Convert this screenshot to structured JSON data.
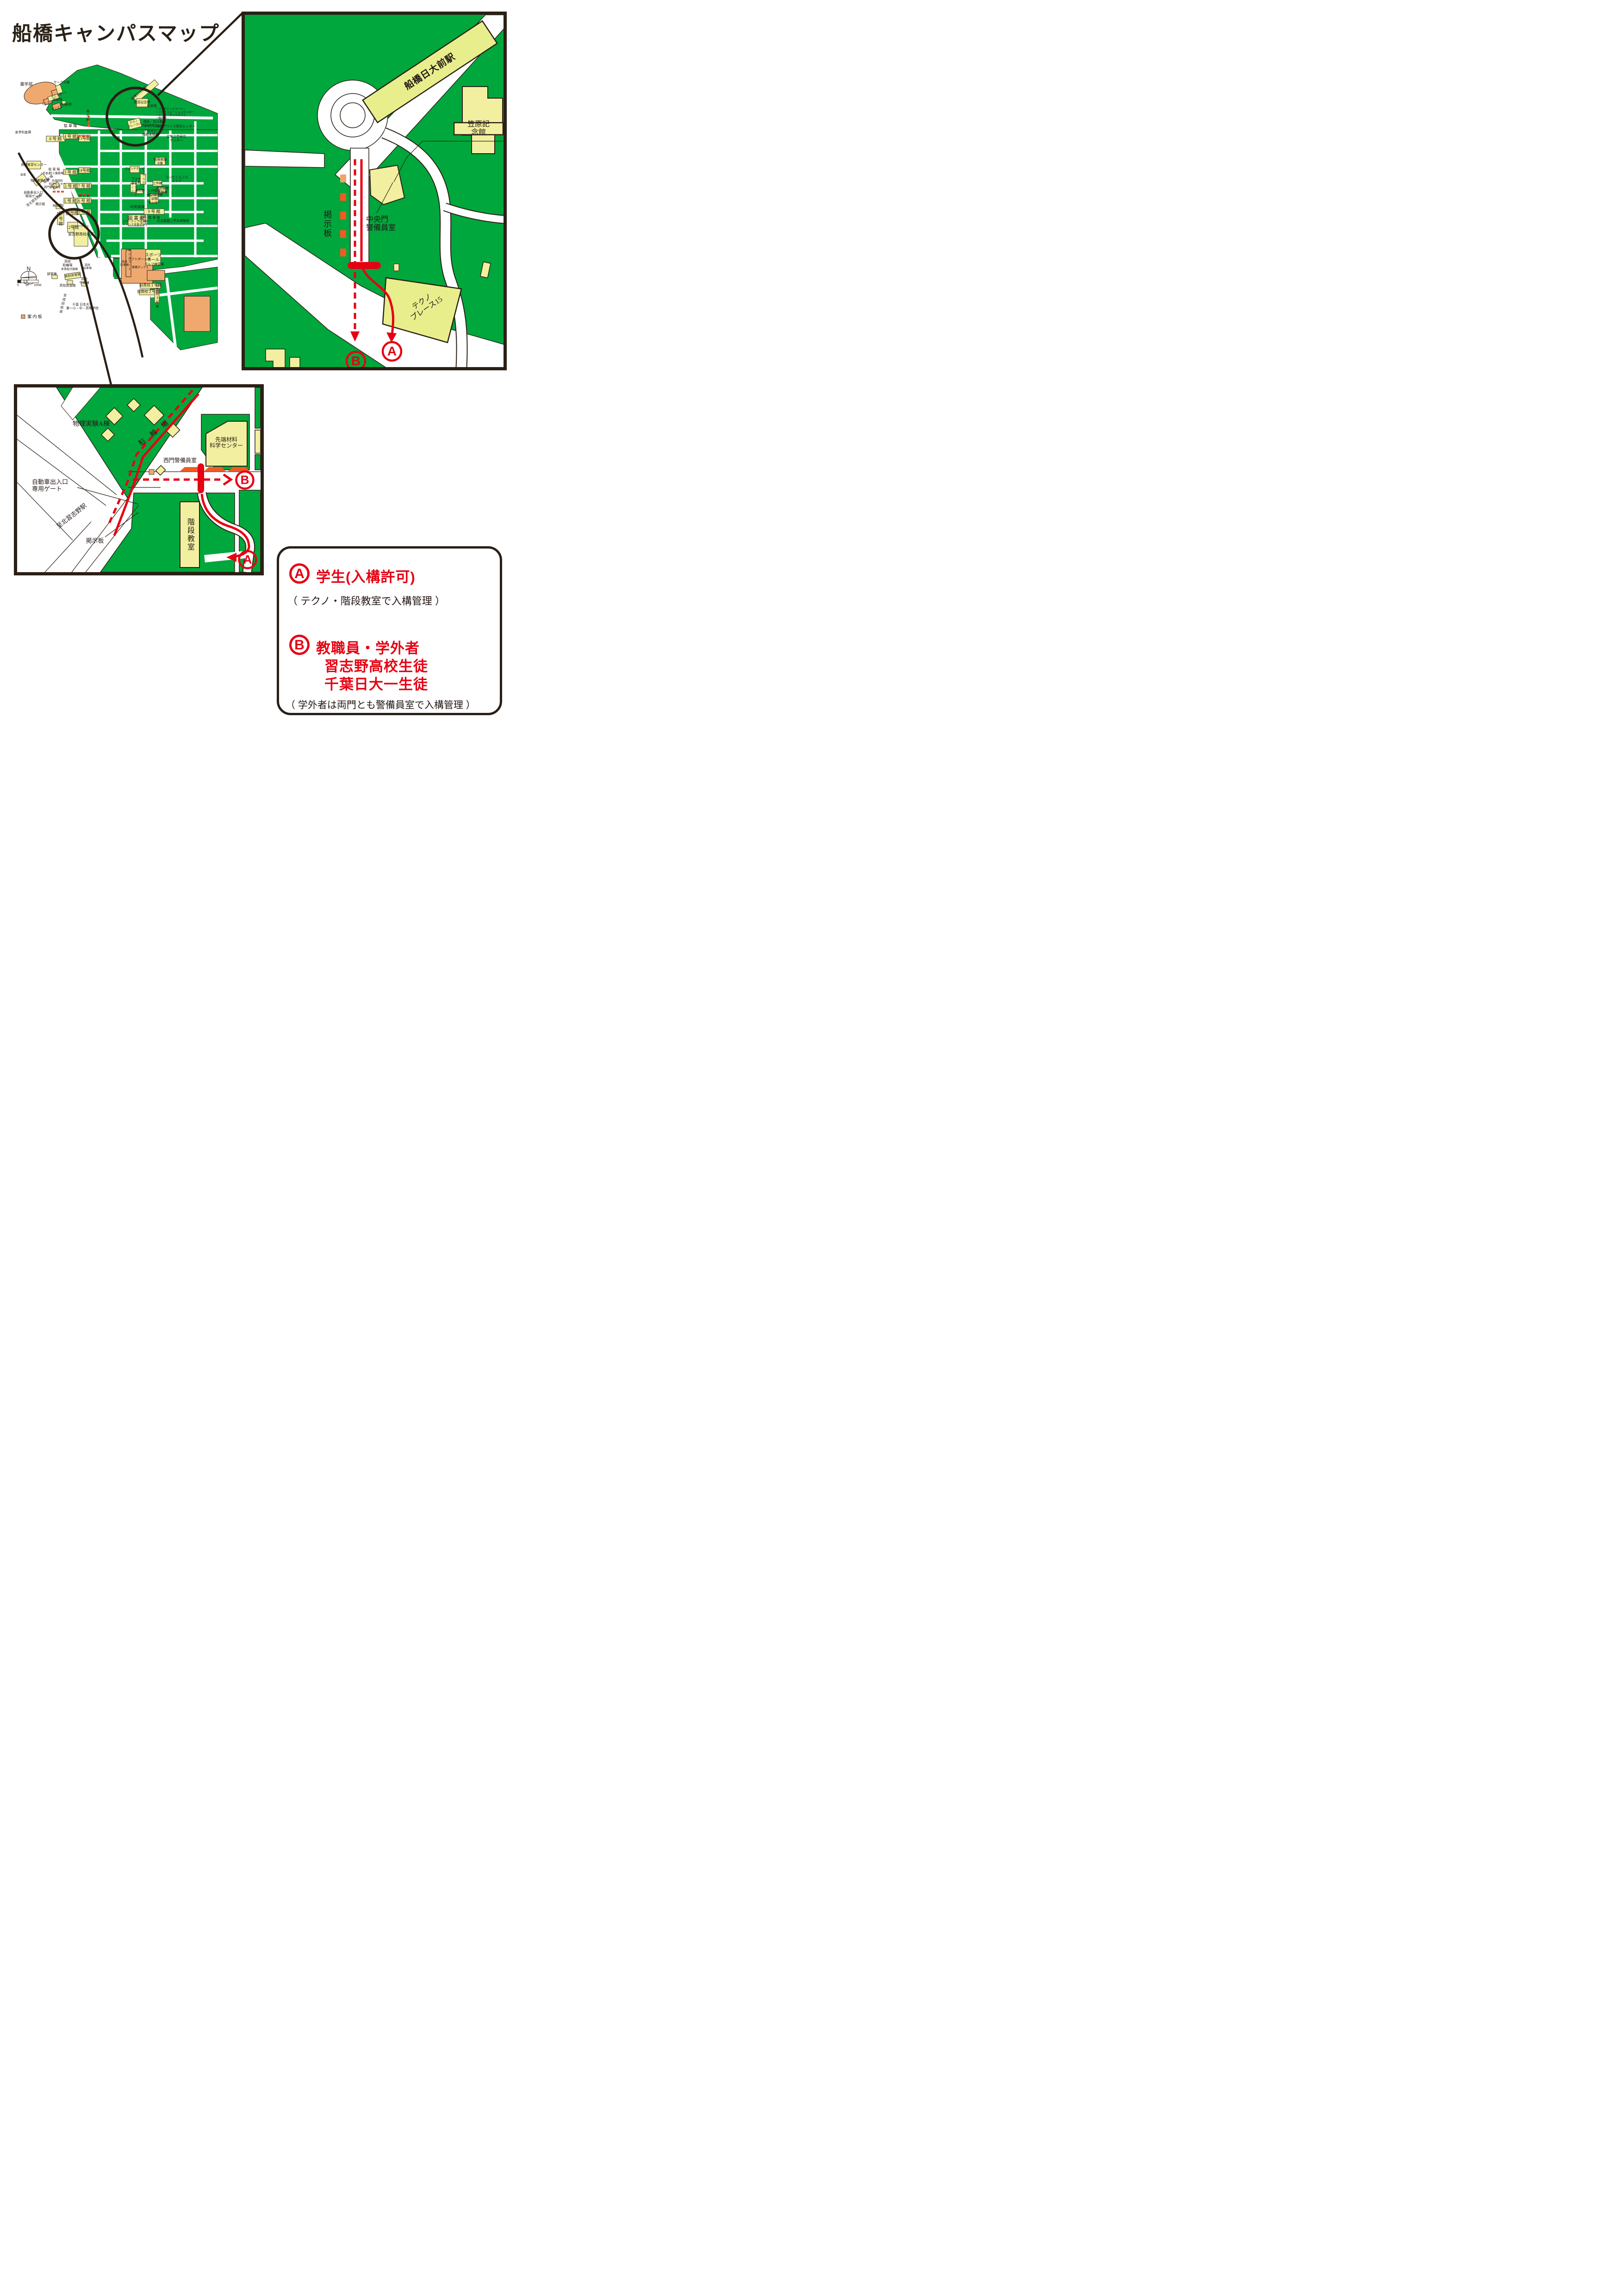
{
  "title": "船橋キャンパスマップ",
  "colors": {
    "campus_green": "#00a73c",
    "building_yellow": "#f2f0a0",
    "station_yellow": "#e9ee8d",
    "field_orange": "#efa96f",
    "board_orange": "#f15a24",
    "board_light_orange": "#f0a568",
    "route_red": "#e60012",
    "line_dark": "#2a2016"
  },
  "overview": {
    "labels": {
      "yakugakubu": "薬学部",
      "circle_bldg": "サークル棟",
      "budokan": "武道館",
      "tennis1": "テニスコート",
      "tennis2": "テニスコート",
      "tennis3": "テニスコート",
      "taiiku_soko": "体育倉庫",
      "keijiban_n": "掲示板",
      "parking_n": "駐 車 場",
      "kakugakka_soko": "各学科倉庫",
      "b8": "8 号 館",
      "b4": "4 号 館",
      "b13": "13号館",
      "b3": "3 号 館",
      "b14": "14号館",
      "sokuryo": "測量実習センター",
      "parking_w": "駐 車 場",
      "soko2": "2 号倉庫",
      "gomi": "ゴミ集積場",
      "soko": "倉庫",
      "station": "船橋日大前駅",
      "kasahara": "笠原記念館",
      "parking_e": "駐車場",
      "facilities": "・リーディングコーナー\n・インフォメーションセンター\n・インターネットカフェ\n・購買部",
      "kankyo": "環境・防災都市\n共同研究センター",
      "micro": "マイクロ機能デバイス研究センター",
      "doshitsu": "土質及び\n機械実験棟",
      "kuki": "空気力学研究\nセンター",
      "butsuri_b": "物理実験\nB棟",
      "techno": "テクノ\nプレース15",
      "conbini": "コンビニエンス\nストア",
      "davinci": "ダビンチホール",
      "pascal": "パスカルホール",
      "plaza": "プラザ\n習志野",
      "faraday": "ファラデイ\nホール",
      "kobai": "購買部",
      "kosaku": "工作棟",
      "kosaku_gijutsu": "工作技術\nセンター",
      "nainen": "内燃機関\n実験棟",
      "ogata": "大型構造物\n試験\nセンター",
      "teien": "中央庭園",
      "b9": "9 号 館",
      "parking_9": "駐 車 場",
      "shakai": "社会基盤工学系実験室",
      "tosho": "図 書 館",
      "powerup": "パワーアップセンター\nキャリア支援センター",
      "shoko": "書庫",
      "sports": "スポーツ\nホール",
      "b2": "2 号 館",
      "b7": "7 号 館",
      "b1": "1 号 館",
      "b6": "6 号 館",
      "keijiban_6": "掲 示 板",
      "b11": "11号館",
      "b5": "5 号 館",
      "b10": "10号館",
      "b12": "12号館",
      "honkan": "習志野高校本館",
      "seimon_ov": "西門警備員室",
      "sentan_ov": "先端材料\n科学センター",
      "churinjo_ov": "駐 輪 場",
      "butsuri_a_ov": "物理実験A棟",
      "gate_ov": "自動車出入口\n専用ゲート",
      "kitanarashino_ov": "至北習志野駅",
      "keijiban_w": "掲示板",
      "kaidan_ov": "階段教室",
      "tennis_s": "テニスコート",
      "softball": "ソフトボール場",
      "keibi_box": "警備ボックス",
      "golf": "ゴルフ練習場",
      "hs_parking_l": "高校\n駐車場",
      "hs_churinjo": "高校\n駐輪場",
      "taiikukan_fuzoku": "体育館付属棟",
      "bushitsu": "部室棟",
      "hs_taiikukan": "高校体育館",
      "hs_shuei": "高校\n守衛棟",
      "hs_budokan": "高校武道館",
      "hs_parking_r": "高校\n駐車場",
      "narita": "至成田街道",
      "chiba": "千葉 日本大学\n第一小・中・高等学校",
      "kyu1": "旧高校１号館",
      "kyu2": "旧高校２号館",
      "kyu3": "旧高校３号館"
    },
    "compass_n": "N",
    "scale": {
      "zero": "0",
      "fifty": "50",
      "hundred": "100M"
    },
    "annaiban": "案 内 板"
  },
  "inset_central": {
    "station": "船橋日大前駅",
    "kasahara": "笠原記念館",
    "keijiban": "掲示板",
    "gate_room": "中央門\n警備員室",
    "techno": "テクノ\nプレース15",
    "a": "A",
    "b": "B"
  },
  "inset_west": {
    "butsuri_a": "物理実験A棟",
    "churinjo": "駐 輪 場",
    "sentan": "先端材料\n科学センター",
    "seimon": "西門警備員室",
    "gate": "自動車出入口\n専用ゲート",
    "station_dir": "至北習志野駅",
    "keijiban": "掲示板",
    "kaidan": "階段教室",
    "a": "A",
    "b": "B"
  },
  "legend": {
    "a_letter": "A",
    "a_title": "学生(入構許可)",
    "a_note": "（ テクノ・階段教室で入構管理 ）",
    "b_letter": "B",
    "b_line1": "教職員・学外者",
    "b_line2": "習志野高校生徒",
    "b_line3": "千葉日大一生徒",
    "b_note": "（ 学外者は両門とも警備員室で入構管理 ）"
  }
}
